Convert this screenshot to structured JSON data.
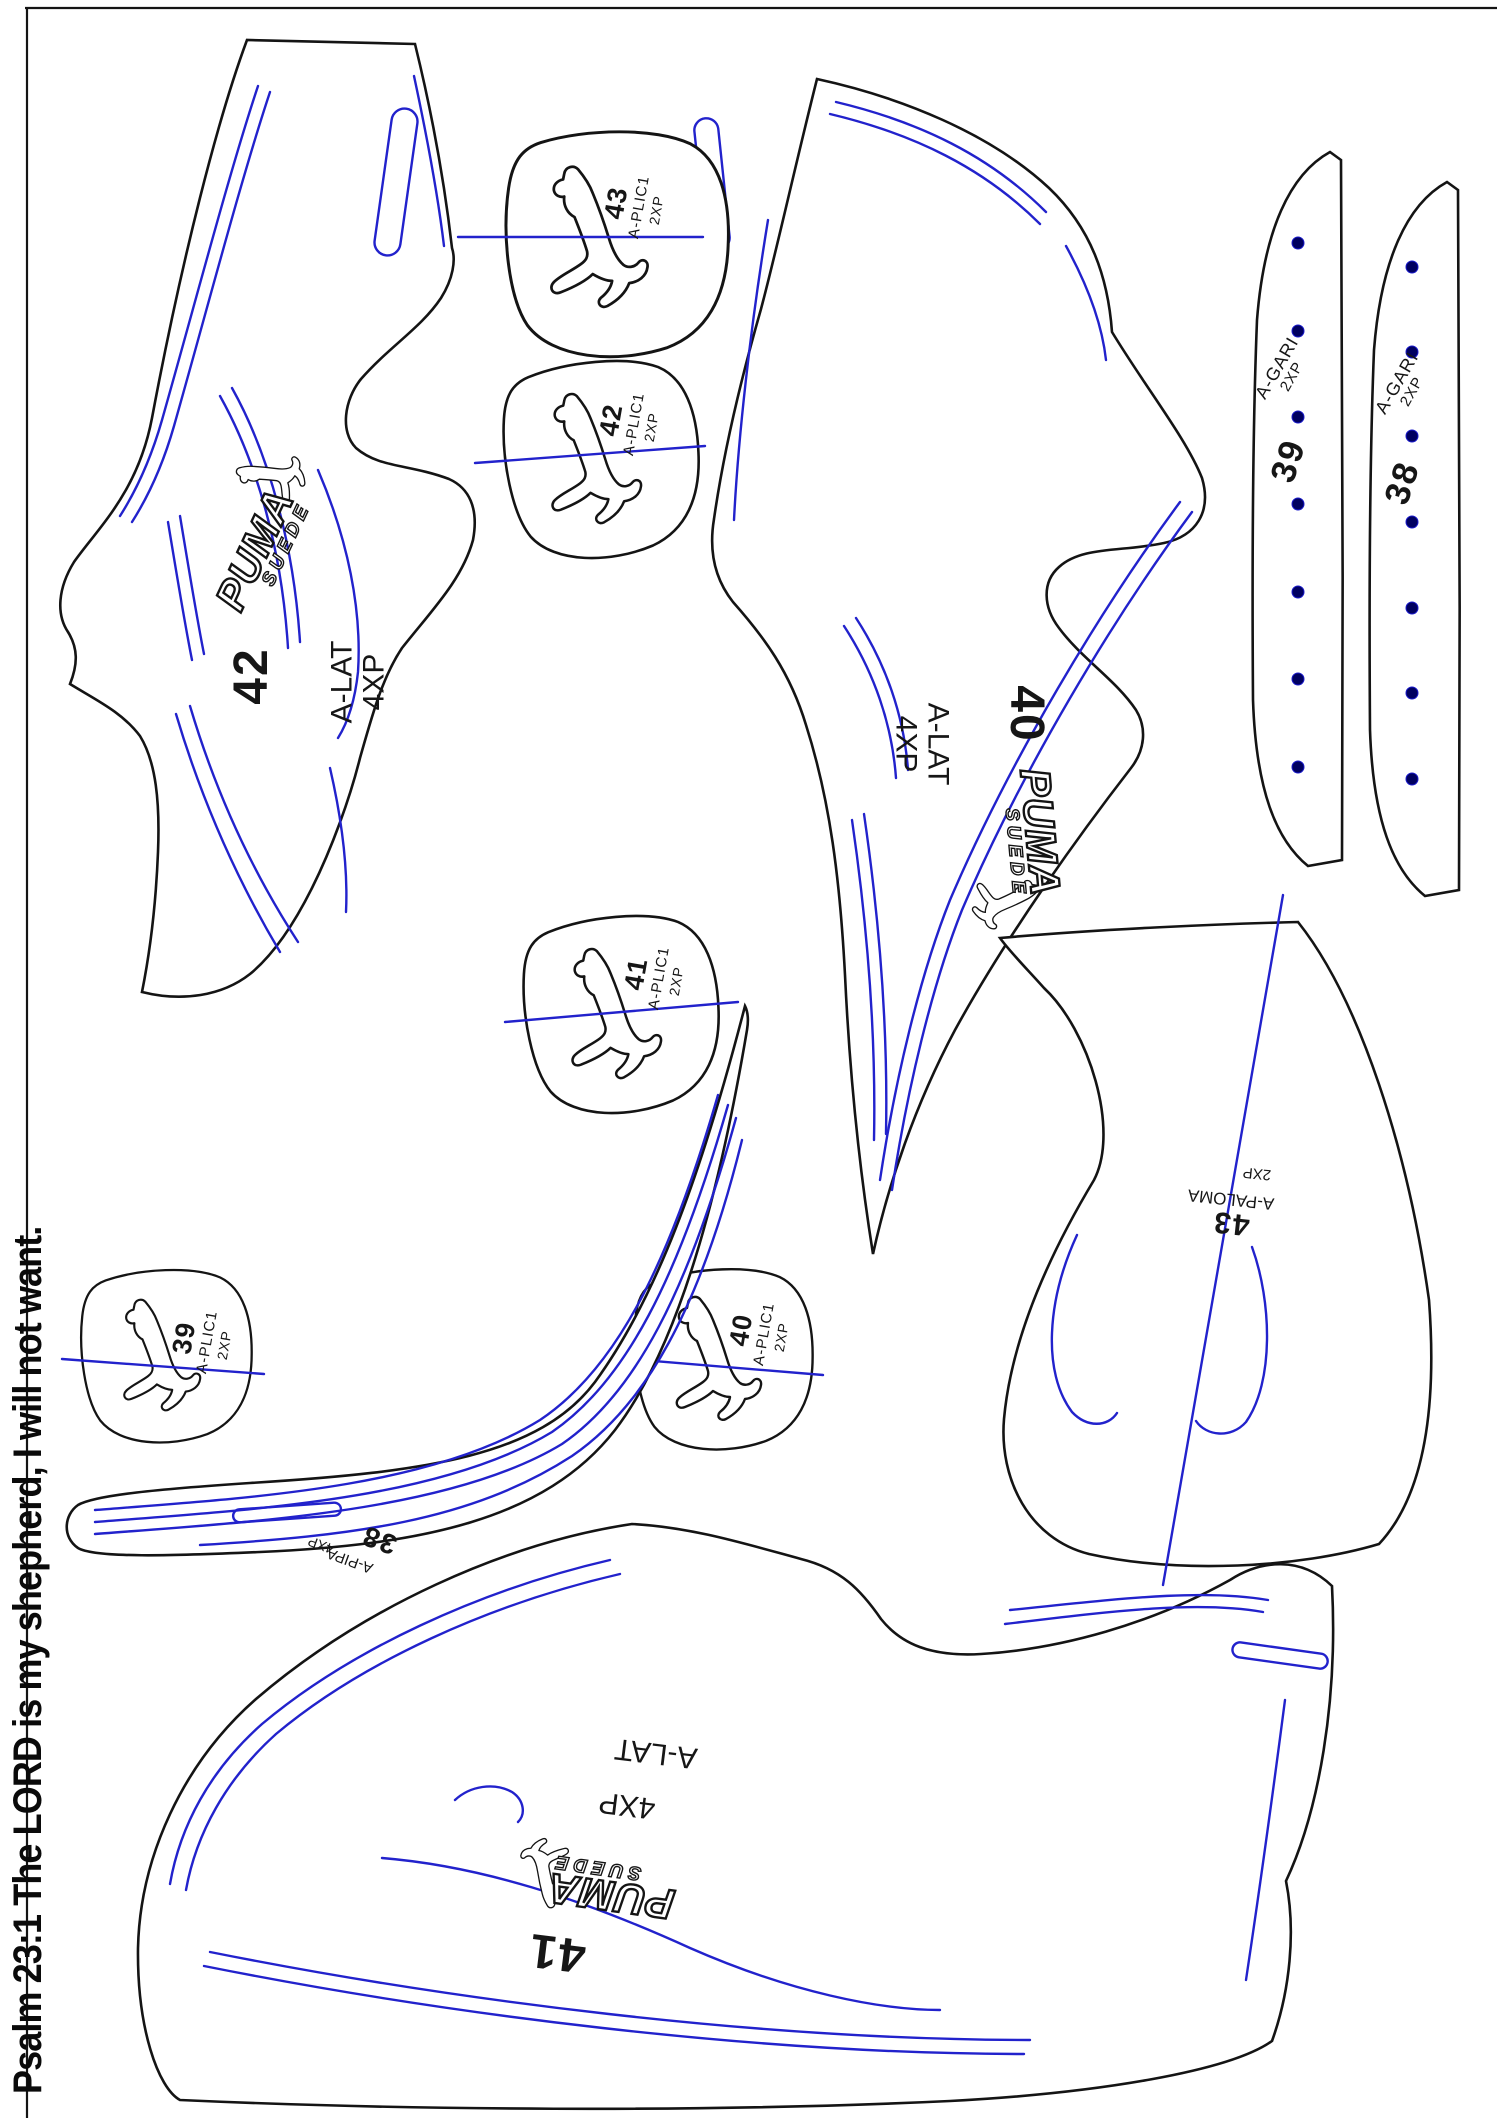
{
  "document": {
    "kind": "shoe-cutting-pattern-sheet"
  },
  "brand": {
    "wordmark": "PUMA",
    "sub": "SUEDE"
  },
  "footer": {
    "verse": "Psalm 23:1 The LORD is my shepherd, I will not want."
  },
  "colors": {
    "outline": "#141414",
    "stitch": "#2222cc",
    "dot": "#000060",
    "paper": "#ffffff"
  },
  "pieces": {
    "lat42": {
      "number": "42",
      "part": "A-LAT",
      "qty": "4XP"
    },
    "lat40": {
      "number": "40",
      "part": "A-LAT",
      "qty": "4XP"
    },
    "lat41": {
      "number": "41",
      "part": "A-LAT",
      "qty": "4XP"
    },
    "plic43": {
      "number": "43",
      "part": "A-PLIC1",
      "qty": "2XP"
    },
    "plic42": {
      "number": "42",
      "part": "A-PLIC1",
      "qty": "2XP"
    },
    "plic41": {
      "number": "41",
      "part": "A-PLIC1",
      "qty": "2XP"
    },
    "plic40": {
      "number": "40",
      "part": "A-PLIC1",
      "qty": "2XP"
    },
    "plic39": {
      "number": "39",
      "part": "A-PLIC1",
      "qty": "2XP"
    },
    "gari39": {
      "number": "39",
      "part": "A-GARI",
      "qty": "2XP"
    },
    "gari38": {
      "number": "38",
      "part": "A-GARI",
      "qty": "2XP"
    },
    "pipa38": {
      "number": "38",
      "part": "A-PIPA",
      "qty": "4XP"
    },
    "paloma43": {
      "number": "43",
      "part": "A-PALOMA",
      "qty": "2XP"
    }
  }
}
